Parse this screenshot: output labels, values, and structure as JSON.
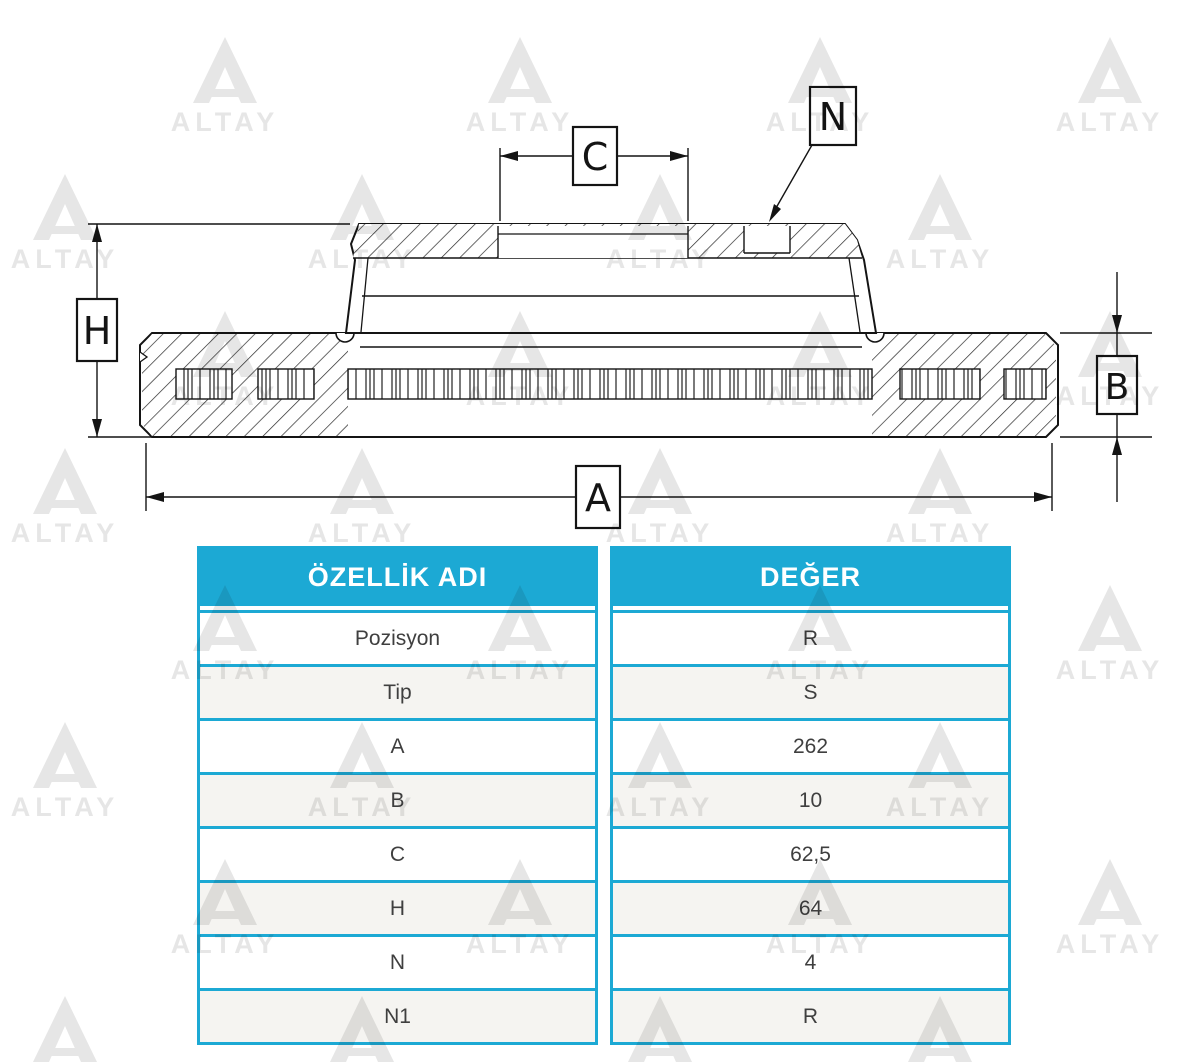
{
  "watermark": {
    "text": "ALTAY"
  },
  "diagram": {
    "dimension_labels": {
      "a": "A",
      "b": "B",
      "c": "C",
      "h": "H",
      "n": "N"
    }
  },
  "table": {
    "columns": {
      "property": "ÖZELLİK ADI",
      "value": "DEĞER"
    },
    "rows": [
      {
        "property": "Pozisyon",
        "value": "R"
      },
      {
        "property": "Tip",
        "value": "S"
      },
      {
        "property": "A",
        "value": "262"
      },
      {
        "property": "B",
        "value": "10"
      },
      {
        "property": "C",
        "value": "62,5"
      },
      {
        "property": "H",
        "value": "64"
      },
      {
        "property": "N",
        "value": "4"
      },
      {
        "property": "N1",
        "value": "R"
      }
    ]
  },
  "colors": {
    "accent": "#1ca9d4",
    "row_alt": "#f5f4f1",
    "line": "#141414",
    "watermark": "#e4e4e4"
  }
}
